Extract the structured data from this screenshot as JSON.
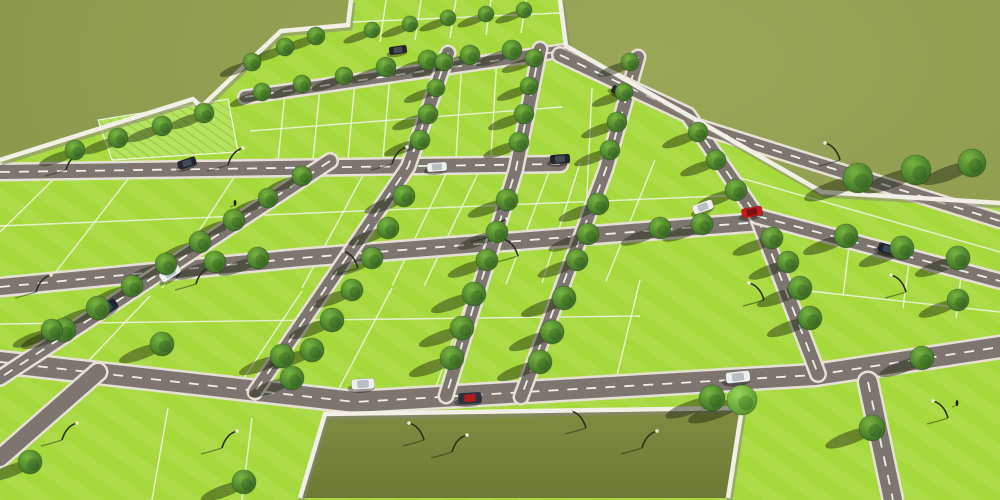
{
  "scene": {
    "title": "Aerial 3D render of plotted land development with roads, trees, boundary walls, cars and a park parcel",
    "canvas": {
      "width": 1000,
      "height": 500
    },
    "colors": {
      "ground": "#8e9a4d",
      "ground_light": "#9aa658",
      "ground_dark": "#7e8b42",
      "plot": "#a6d93c",
      "plot_deep": "#97cc30",
      "road": "#7d7570",
      "curb": "#e7e1d5",
      "dash": "#f6f5ef",
      "wall": "#f1efe6",
      "wall_shadow": "#8b857a",
      "pond": "#808c41",
      "pond_dark": "#6d7a35",
      "tree_light": "#77b53f",
      "tree_dark": "#2d5a1f",
      "tree_bright_light": "#98d95a",
      "tree_bright_dark": "#457f20",
      "shadow": "rgba(27,36,13,0.45)",
      "lamp_pole": "#2a301b",
      "lamp_head": "#e9ead0",
      "plot_line": "#f2f6e8",
      "lawn_a": "#b4e35e",
      "lawn_b": "#9ccb49"
    },
    "dev_polygon": "0,160 195,98 205,106 283,30 350,24 352,0 560,0 566,46 700,122 822,192 1000,203 1000,500 0,500",
    "textured_plot": "98,120 228,99 238,152 112,160",
    "pond": {
      "points": "325,414 742,408 728,498 300,498"
    },
    "walls": [
      {
        "pts": "0,160 193,99 201,107 281,31 348,25 351,0"
      },
      {
        "pts": "560,0 566,46 700,122 822,192 1000,203"
      },
      {
        "pts": "300,498 325,414 742,408 728,498"
      }
    ],
    "roads": [
      {
        "pts": "245,97 562,51",
        "w": 11,
        "dash": 1
      },
      {
        "pts": "0,172 560,164",
        "w": 14,
        "dash": 1
      },
      {
        "pts": "0,287 300,258 760,222",
        "w": 16,
        "dash": 1
      },
      {
        "pts": "0,362 355,402 815,375 1000,347",
        "w": 20,
        "dash": 1
      },
      {
        "pts": "330,161 0,378",
        "w": 13,
        "dash": 1
      },
      {
        "pts": "448,53 408,167 255,392",
        "w": 12,
        "dash": 1
      },
      {
        "pts": "540,49 516,169 446,396",
        "w": 12,
        "dash": 1
      },
      {
        "pts": "638,57 606,169 521,397",
        "w": 12,
        "dash": 1
      },
      {
        "pts": "560,55 688,115 757,216 818,374",
        "w": 13,
        "dash": 1
      },
      {
        "pts": "700,127 1000,221",
        "w": 12,
        "dash": 1
      },
      {
        "pts": "757,216 1000,281",
        "w": 13,
        "dash": 1
      },
      {
        "pts": "98,372 0,458",
        "w": 16,
        "dash": 0
      },
      {
        "pts": "868,382 893,500",
        "w": 18,
        "dash": 1
      }
    ],
    "plot_lines": [
      [
        386,
        0,
        380,
        42
      ],
      [
        421,
        0,
        415,
        40
      ],
      [
        456,
        0,
        450,
        38
      ],
      [
        491,
        0,
        486,
        35
      ],
      [
        526,
        0,
        521,
        33
      ],
      [
        352,
        22,
        560,
        13
      ],
      [
        250,
        131,
        562,
        107
      ],
      [
        285,
        93,
        278,
        161
      ],
      [
        320,
        87,
        313,
        160
      ],
      [
        355,
        81,
        348,
        159
      ],
      [
        390,
        74,
        383,
        158
      ],
      [
        462,
        60,
        456,
        158
      ],
      [
        497,
        56,
        491,
        157
      ],
      [
        532,
        52,
        526,
        156
      ],
      [
        0,
        226,
        745,
        195
      ],
      [
        60,
        173,
        0,
        232
      ],
      [
        135,
        170,
        48,
        282
      ],
      [
        240,
        168,
        162,
        288
      ],
      [
        368,
        166,
        302,
        288
      ],
      [
        450,
        166,
        392,
        286
      ],
      [
        482,
        165,
        424,
        286
      ],
      [
        552,
        164,
        506,
        284
      ],
      [
        580,
        163,
        542,
        283
      ],
      [
        655,
        160,
        606,
        281
      ],
      [
        592,
        88,
        585,
        235
      ],
      [
        0,
        324,
        640,
        316
      ],
      [
        150,
        296,
        76,
        374
      ],
      [
        302,
        291,
        232,
        396
      ],
      [
        392,
        288,
        334,
        398
      ],
      [
        472,
        286,
        432,
        398
      ],
      [
        562,
        283,
        524,
        397
      ],
      [
        640,
        280,
        612,
        396
      ],
      [
        730,
        175,
        1000,
        252
      ],
      [
        800,
        290,
        1000,
        312
      ],
      [
        850,
        238,
        843,
        296
      ],
      [
        910,
        255,
        903,
        308
      ],
      [
        962,
        268,
        956,
        318
      ],
      [
        168,
        408,
        152,
        500
      ],
      [
        252,
        418,
        242,
        500
      ]
    ],
    "trees": [
      [
        75,
        150,
        10
      ],
      [
        118,
        138,
        10
      ],
      [
        162,
        126,
        10
      ],
      [
        204,
        113,
        10
      ],
      [
        252,
        62,
        9
      ],
      [
        285,
        47,
        9
      ],
      [
        316,
        36,
        9
      ],
      [
        262,
        92,
        9
      ],
      [
        302,
        84,
        9
      ],
      [
        344,
        76,
        9
      ],
      [
        386,
        67,
        10
      ],
      [
        428,
        60,
        10
      ],
      [
        470,
        55,
        10
      ],
      [
        512,
        50,
        10
      ],
      [
        372,
        30,
        8
      ],
      [
        410,
        24,
        8
      ],
      [
        448,
        18,
        8
      ],
      [
        486,
        14,
        8
      ],
      [
        524,
        10,
        8
      ],
      [
        444,
        62,
        9
      ],
      [
        436,
        88,
        9
      ],
      [
        428,
        114,
        10
      ],
      [
        420,
        140,
        10
      ],
      [
        404,
        196,
        11
      ],
      [
        388,
        228,
        11
      ],
      [
        372,
        258,
        11
      ],
      [
        352,
        290,
        11
      ],
      [
        332,
        320,
        12
      ],
      [
        312,
        350,
        12
      ],
      [
        292,
        378,
        12
      ],
      [
        534,
        58,
        9
      ],
      [
        529,
        86,
        9
      ],
      [
        524,
        114,
        10
      ],
      [
        519,
        142,
        10
      ],
      [
        507,
        200,
        11
      ],
      [
        497,
        232,
        11
      ],
      [
        487,
        260,
        11
      ],
      [
        474,
        294,
        12
      ],
      [
        462,
        328,
        12
      ],
      [
        452,
        358,
        12
      ],
      [
        630,
        62,
        9
      ],
      [
        624,
        92,
        9
      ],
      [
        617,
        122,
        10
      ],
      [
        610,
        150,
        10
      ],
      [
        598,
        204,
        11
      ],
      [
        588,
        234,
        11
      ],
      [
        577,
        260,
        11
      ],
      [
        564,
        298,
        12
      ],
      [
        552,
        332,
        12
      ],
      [
        540,
        362,
        12
      ],
      [
        302,
        176,
        10
      ],
      [
        268,
        198,
        10
      ],
      [
        234,
        220,
        11
      ],
      [
        200,
        242,
        11
      ],
      [
        166,
        264,
        11
      ],
      [
        132,
        286,
        11
      ],
      [
        98,
        308,
        12
      ],
      [
        64,
        330,
        12
      ],
      [
        215,
        262,
        11
      ],
      [
        258,
        258,
        11
      ],
      [
        660,
        228,
        11
      ],
      [
        702,
        224,
        11
      ],
      [
        698,
        132,
        10
      ],
      [
        716,
        160,
        10
      ],
      [
        736,
        190,
        11
      ],
      [
        772,
        238,
        11
      ],
      [
        788,
        262,
        11
      ],
      [
        800,
        288,
        12
      ],
      [
        810,
        318,
        12
      ],
      [
        858,
        178,
        15
      ],
      [
        916,
        170,
        15
      ],
      [
        972,
        163,
        14
      ],
      [
        846,
        236,
        12
      ],
      [
        902,
        248,
        12
      ],
      [
        958,
        258,
        12
      ],
      [
        712,
        398,
        13
      ],
      [
        922,
        358,
        12
      ],
      [
        872,
        428,
        13
      ],
      [
        958,
        300,
        11
      ],
      [
        742,
        400,
        15,
        1
      ],
      [
        52,
        330,
        11
      ],
      [
        162,
        344,
        12
      ],
      [
        282,
        356,
        12
      ],
      [
        244,
        482,
        12
      ],
      [
        30,
        462,
        12
      ]
    ],
    "lamps": [
      [
        66,
        170,
        1
      ],
      [
        228,
        165,
        1
      ],
      [
        392,
        164,
        1
      ],
      [
        36,
        292,
        1
      ],
      [
        196,
        284,
        1
      ],
      [
        358,
        268,
        -1
      ],
      [
        518,
        256,
        -1
      ],
      [
        62,
        440,
        1
      ],
      [
        222,
        448,
        1
      ],
      [
        424,
        440,
        -1
      ],
      [
        586,
        428,
        -1
      ],
      [
        764,
        300,
        -1
      ],
      [
        906,
        292,
        -1
      ],
      [
        948,
        418,
        -1
      ],
      [
        492,
        236,
        1
      ],
      [
        840,
        160,
        -1
      ],
      [
        452,
        452,
        1
      ],
      [
        642,
        448,
        1
      ]
    ],
    "car_colors": {
      "white": {
        "body": "#eef0f0",
        "roof": "#b8bec4"
      },
      "silver": {
        "body": "#aeb6bd",
        "roof": "#7f8890"
      },
      "dark": {
        "body": "#23262c",
        "roof": "#454b54"
      },
      "navy": {
        "body": "#1d2534",
        "roof": "#39465e"
      },
      "red": {
        "body": "#c31c1c",
        "roof": "#7e0f12"
      },
      "sport": {
        "body": "#2b3240",
        "roof": "#b01c1c"
      }
    },
    "cars": [
      [
        398,
        50,
        -8,
        "dark",
        0.8
      ],
      [
        470,
        54,
        -8,
        "silver",
        0.8
      ],
      [
        620,
        92,
        25,
        "dark",
        0.8
      ],
      [
        187,
        163,
        -18,
        "dark",
        0.85
      ],
      [
        437,
        167,
        -4,
        "white",
        0.9
      ],
      [
        560,
        159,
        -4,
        "dark",
        0.9
      ],
      [
        170,
        273,
        -33,
        "white",
        1
      ],
      [
        107,
        308,
        -33,
        "navy",
        1
      ],
      [
        363,
        384,
        -3,
        "white",
        1.05
      ],
      [
        470,
        398,
        -3,
        "sport",
        1.05
      ],
      [
        703,
        207,
        -20,
        "white",
        0.95
      ],
      [
        752,
        212,
        -10,
        "red",
        0.95
      ],
      [
        738,
        377,
        -6,
        "white",
        1.1
      ],
      [
        888,
        249,
        16,
        "navy",
        0.9
      ]
    ],
    "pedestrians": [
      [
        235,
        203
      ],
      [
        957,
        403
      ]
    ]
  }
}
